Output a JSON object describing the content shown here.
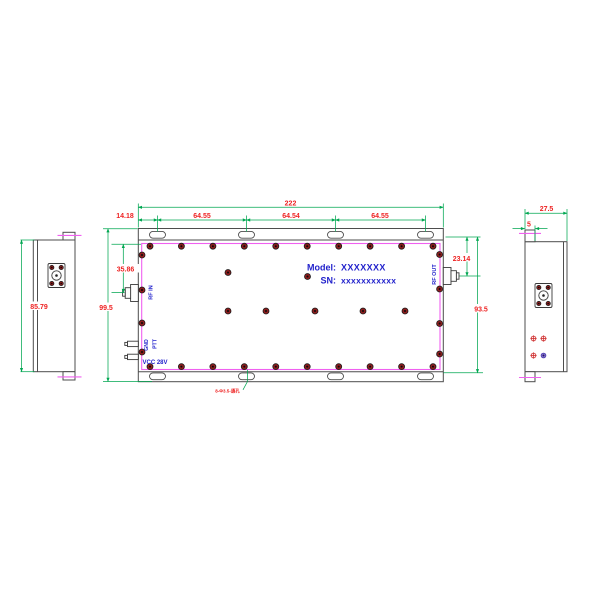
{
  "drawing_type": "rf-module-outline-drawing",
  "views": {
    "left_side": {
      "dims": {
        "body_height": "85.79"
      }
    },
    "main_top": {
      "labels": {
        "model_label": "Model:",
        "model_value": "XXXXXXX",
        "sn_label": "SN:",
        "sn_value": "xxxxxxxxxxx",
        "rf_in": "RF IN",
        "rf_out": "RF OUT",
        "gnd": "GND",
        "ptt": "PTT",
        "vcc": "VCC 28V"
      },
      "dims": {
        "total_width": "222",
        "edge_to_first_slot": "14.18",
        "slot_pitch_1": "64.55",
        "slot_pitch_2": "64.54",
        "slot_pitch_3": "64.55",
        "overall_height": "99.5",
        "rf_in_offset": "35.86",
        "rf_out_offset": "23.14",
        "body_height": "93.5",
        "mounting_hole_note": "8-Φ3.5-通孔"
      }
    },
    "right_side": {
      "dims": {
        "overall_depth": "27.5",
        "flange_step": "5"
      }
    }
  },
  "colors": {
    "dimension_lines": "#00a651",
    "dimension_text": "#ee2222",
    "cover_plate_outline": "#f060f0",
    "silkscreen_text": "#2222cc",
    "screw_fill": "#8c1c1c",
    "body_outline": "#4d4d4d"
  }
}
